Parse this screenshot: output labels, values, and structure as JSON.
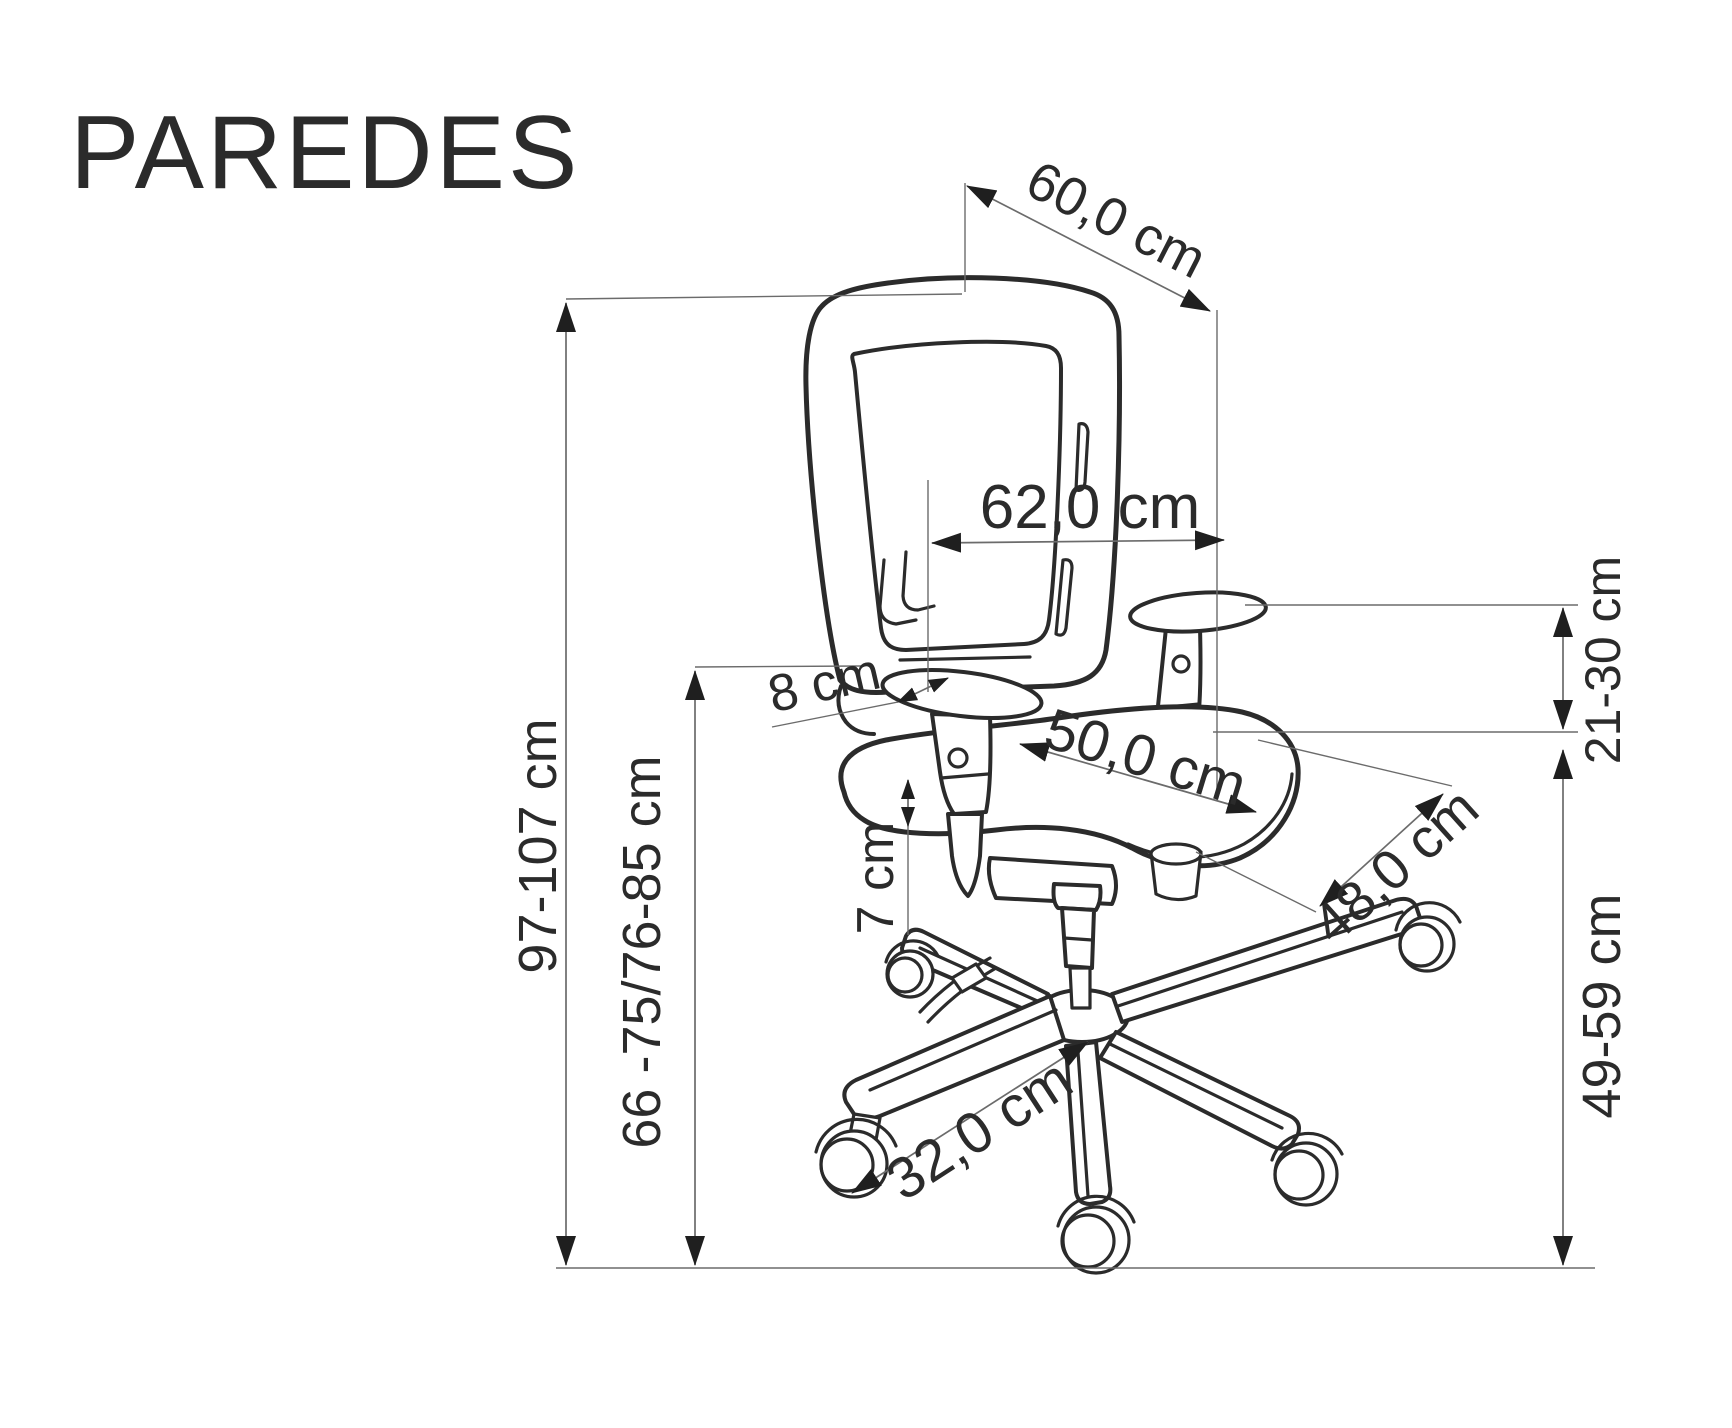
{
  "title": "PAREDES",
  "colors": {
    "ink": "#2b2b2b",
    "dimension_line": "#6b6b6b",
    "arrow": "#1f1f1f",
    "background": "#ffffff"
  },
  "dims": {
    "backrest_depth": "60,0 cm",
    "overall_width": "62,0 cm",
    "armrest_pad_width": "8 cm",
    "lift_range": "7 cm",
    "seat_width": "50,0 cm",
    "seat_depth": "48,0 cm",
    "armrest_height": "21-30 cm",
    "overall_height": "97-107 cm",
    "backrest_bottom_height": "66 -75/76-85 cm",
    "seat_height": "49-59 cm",
    "base_leg_length": "32,0 cm"
  }
}
